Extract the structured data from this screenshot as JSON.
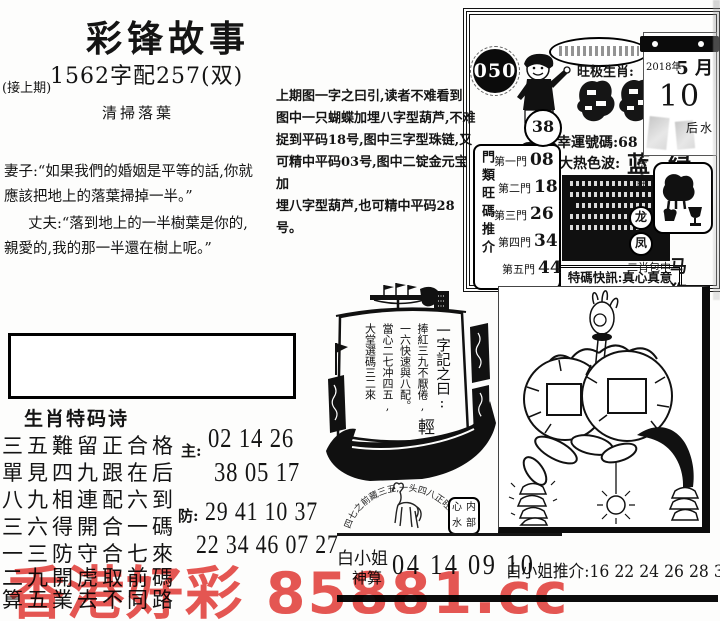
{
  "watermark": {
    "text": "香港好彩 85881.cc",
    "color": "#e23b36"
  },
  "header": {
    "title": "彩锋故事",
    "issue_line": "1562字配257(双)",
    "continued": "(接上期)",
    "story_title": "清掃落葉"
  },
  "story": {
    "lines": [
      "妻子:“如果我們的婚姻是平等的話,你就",
      "應該把地上的落葉掃掉一半。”",
      "丈夫:“落到地上的一半樹葉是你的,",
      "親愛的,我的那一半還在樹上呢。”"
    ]
  },
  "analysis": {
    "lines": [
      "上期图一字之曰引,读者不难看到",
      "图中一只蝴蝶加埋八字型葫芦,不难",
      "捉到平码18号,图中三字型珠链,又",
      "可精中平码03号,图中二锭金元宝加",
      "埋八字型葫芦,也可精中平码28号。"
    ]
  },
  "card": {
    "issue_number": "050",
    "ball_number": "38",
    "zodiac_heading": "旺极生肖:",
    "lucky_line": "幸運號碼:68",
    "hot_color_label": "大热色波:",
    "hot_colors": "蓝 绿",
    "special_alert": "特碼快訊:真心真意",
    "calendar": {
      "year": "2018年",
      "month": "5 月",
      "day": "10"
    },
    "right_note": "后水",
    "noble_label": "贵人助",
    "noble_circles": [
      "龙",
      "凤"
    ],
    "two_zodiac_label": "二肖包中",
    "two_zodiac_values": "马 狗",
    "gates_title": "門類旺碼推介",
    "gates": [
      {
        "label": "第一門",
        "value": "08"
      },
      {
        "label": "第二門",
        "value": "18"
      },
      {
        "label": "第三門",
        "value": "26"
      },
      {
        "label": "第四門",
        "value": "34"
      },
      {
        "label": "第五門",
        "value": "44"
      }
    ]
  },
  "poem": {
    "title": "生肖特码诗",
    "lines": [
      "三五難留正合格",
      "單見四九跟在后",
      "八九相連配六到",
      "三六得開合一碼",
      "一三防守合七來",
      "二九開虎取前碼",
      "算五業去不同路"
    ],
    "main_label": "主:",
    "main_numbers": [
      "02 14 26",
      "38 05 17"
    ],
    "guard_label": "防:",
    "guard_numbers": [
      "29 41 10 37",
      "22 34 46 07 27"
    ]
  },
  "ship": {
    "motto": "一字記之曰:",
    "motto_char": "輕",
    "verse": [
      "捧紅三九不厭倦,",
      "一六快速與八配。",
      "當心二七冲四五,",
      "大堂選碼三二來"
    ],
    "arch_text": "四七之前藏三五,一头四八正旺座",
    "inner_box_chars": [
      "心",
      "内",
      "水",
      "部"
    ]
  },
  "bottom": {
    "name_line1": "白小姐",
    "name_line2": "神算",
    "numbers": "04 14 09 10",
    "recommend": "白小姐推介:16 22 24 26 28 36"
  }
}
